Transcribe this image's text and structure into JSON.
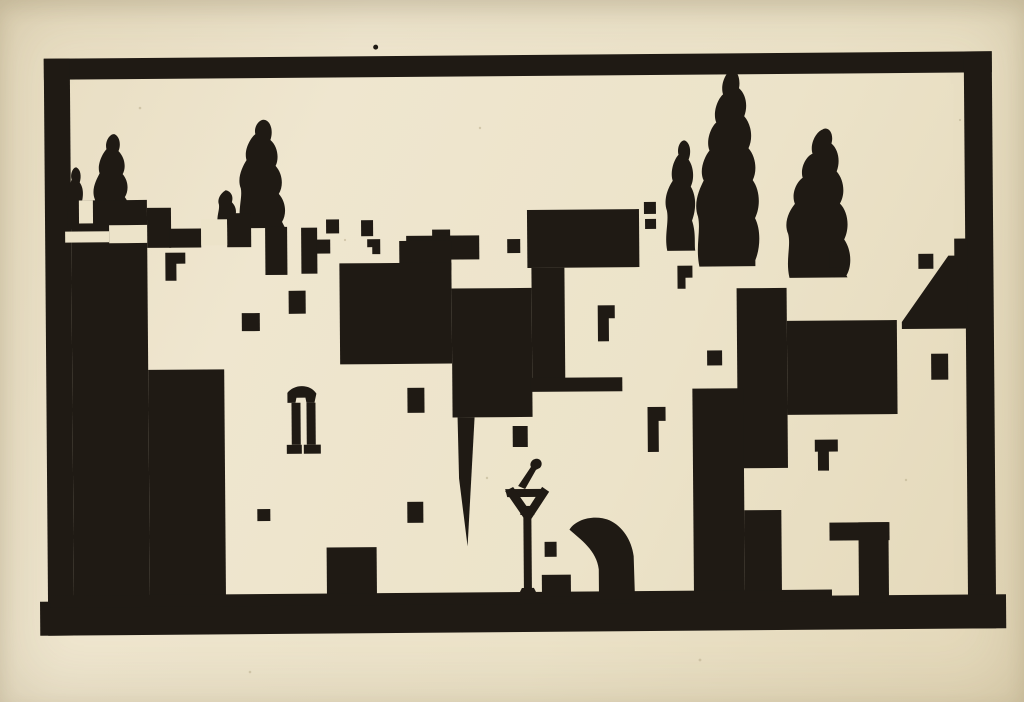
{
  "artwork": {
    "medium": "woodcut relief print, black ink on cream laid paper",
    "subject": "Stylized hillside village: cascading white-walled buildings with dark window openings, cypress trees along the skyline, a lamppost with a bird finial, and an arched shadow, all inside a hand-printed black border",
    "colors": {
      "paper": "#ece3c9",
      "ink": "#1f1a14",
      "speckle": "#b6a987"
    },
    "elements": {
      "border_frame": 1,
      "cypress_trees": 7,
      "building_clusters": 6,
      "window_openings": 22,
      "lamppost": 1,
      "arch_shadow": 1,
      "registration_dot": 1
    }
  }
}
